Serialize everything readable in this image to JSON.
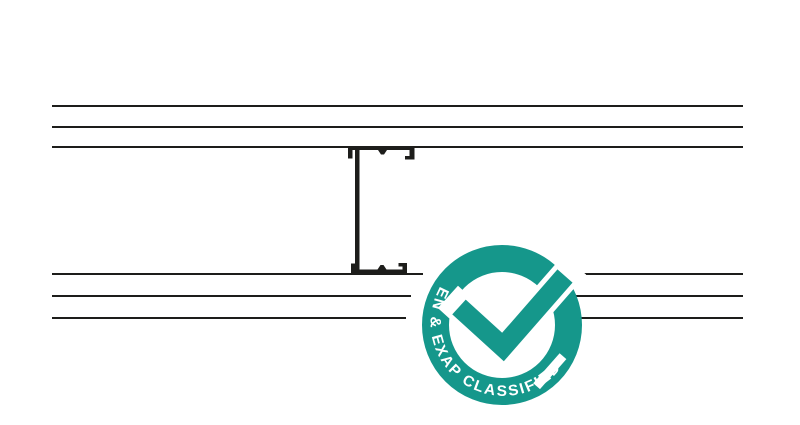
{
  "page": {
    "background_color": "#ffffff",
    "width": 800,
    "height": 425
  },
  "diagram": {
    "description": "Plan-section detail of a partition: twin-layer boards each side of a C-stud cavity",
    "ink_color": "#1d1d1b",
    "board_lines": {
      "stroke_width": 2,
      "segments": [
        {
          "x1": 52,
          "y1": 106,
          "x2": 743,
          "y2": 106
        },
        {
          "x1": 52,
          "y1": 127,
          "x2": 743,
          "y2": 127
        },
        {
          "x1": 52,
          "y1": 147,
          "x2": 743,
          "y2": 147
        },
        {
          "x1": 52,
          "y1": 274,
          "x2": 423,
          "y2": 274
        },
        {
          "x1": 568,
          "y1": 274,
          "x2": 743,
          "y2": 274
        },
        {
          "x1": 52,
          "y1": 296,
          "x2": 411,
          "y2": 296
        },
        {
          "x1": 565,
          "y1": 296,
          "x2": 743,
          "y2": 296
        },
        {
          "x1": 52,
          "y1": 318,
          "x2": 406,
          "y2": 318
        },
        {
          "x1": 581,
          "y1": 318,
          "x2": 743,
          "y2": 318
        }
      ]
    },
    "stud": {
      "label": "C-stud section"
    }
  },
  "badge": {
    "label": "EN & EXAP CLASSIFIED",
    "teal": "#15978B",
    "text_color": "#ffffff",
    "center_x": 502,
    "center_y": 325,
    "ring_outer_radius": 80,
    "ring_thickness": 27
  }
}
